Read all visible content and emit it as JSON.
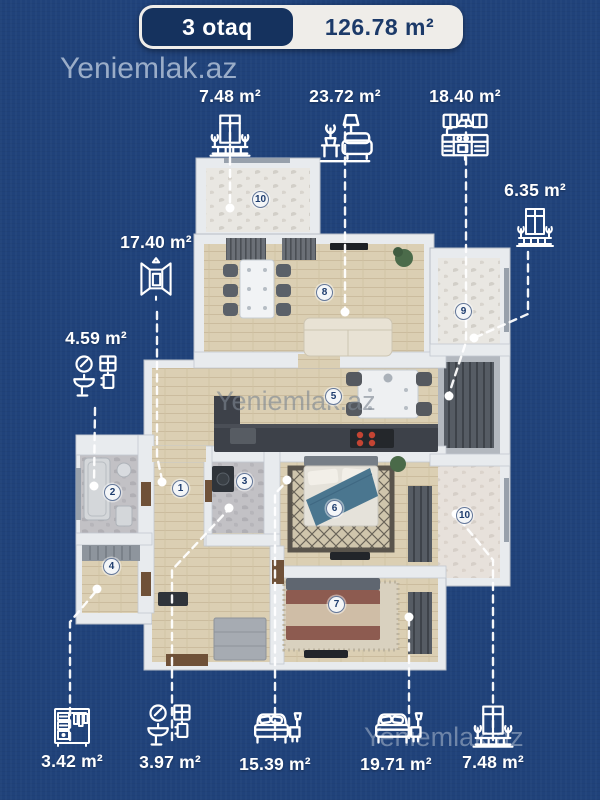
{
  "header": {
    "rooms_badge": "3 otaq",
    "total_area": "126.78 m²"
  },
  "watermarks": {
    "top": "Yeniemlak.az",
    "middle": "Yeniemlak.az",
    "bottom": "Yeniemlak.az"
  },
  "area_labels": [
    {
      "value": "7.48 m²",
      "icon": "balcony-icon"
    },
    {
      "value": "23.72 m²",
      "icon": "sofa-icon"
    },
    {
      "value": "18.40 m²",
      "icon": "kitchen-icon"
    },
    {
      "value": "6.35 m²",
      "icon": "balcony-icon"
    },
    {
      "value": "17.40 m²",
      "icon": "hallway-icon"
    },
    {
      "value": "4.59 m²",
      "icon": "washbasin-icon"
    },
    {
      "value": "3.42 m²",
      "icon": "wardrobe-icon"
    },
    {
      "value": "3.97 m²",
      "icon": "washbasin-icon"
    },
    {
      "value": "15.39 m²",
      "icon": "bed-icon"
    },
    {
      "value": "19.71 m²",
      "icon": "bed-icon"
    },
    {
      "value": "7.48 m²",
      "icon": "balcony-icon"
    }
  ],
  "room_markers": [
    {
      "number": "1"
    },
    {
      "number": "2"
    },
    {
      "number": "3"
    },
    {
      "number": "4"
    },
    {
      "number": "5"
    },
    {
      "number": "6"
    },
    {
      "number": "7"
    },
    {
      "number": "8"
    },
    {
      "number": "9"
    },
    {
      "number": "10"
    },
    {
      "number": "10"
    }
  ],
  "colors": {
    "background": "#20427a",
    "badge_navy": "#15325e",
    "badge_light": "#efede9",
    "badge_text_dark": "#1c3a69",
    "label_text": "#ffffff",
    "wall": "#e8ebee",
    "wood_floor": "#dbcfb3",
    "marble_floor": "#e9e7e2",
    "tile_floor": "#c2c1c5",
    "stove_red": "#c44433",
    "bed_blue": "#4a768f",
    "bed_maroon": "#8d5b50",
    "watermark": "#aebfd6"
  }
}
